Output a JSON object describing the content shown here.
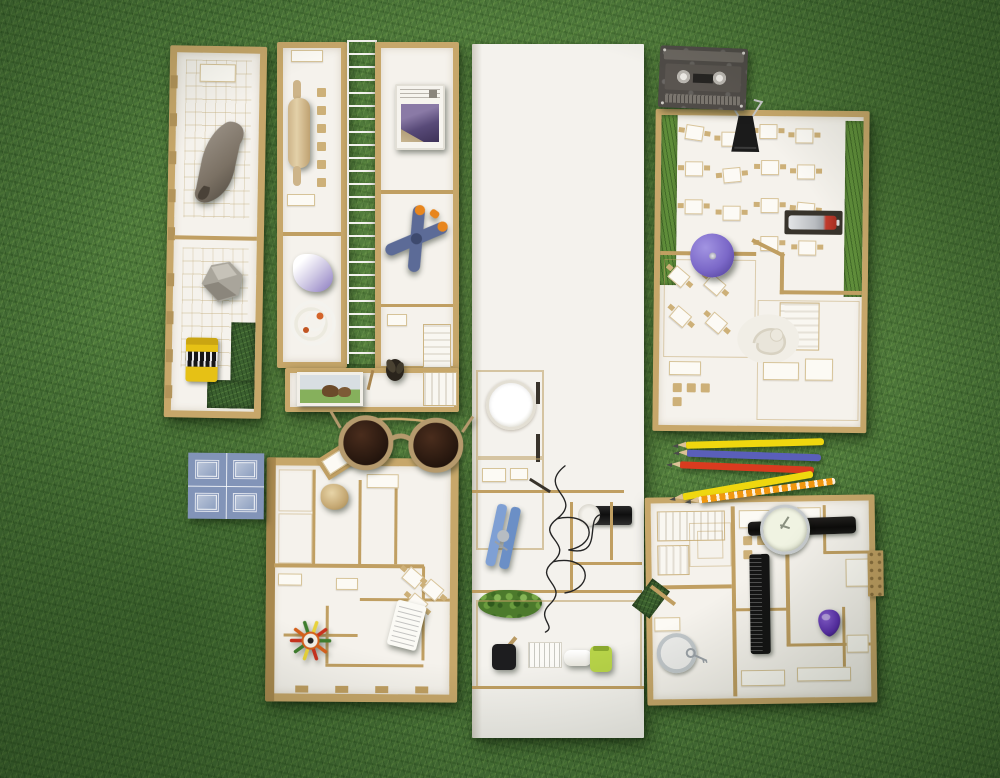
{
  "scene": {
    "title": "Architectural model flat-lay on artificial grass",
    "description": "Top-down photograph of white and cardboard architectural floor-plan models arranged on green artificial grass, staged with everyday objects used as scale props: a cassette tape, sunglasses, five colored pencils, a wristwatch, a spring clamp, a clothespin, a rolling pin, rocks, thread, a comb, a battery, a yo-yo, a blue cement tile and more."
  },
  "palette": {
    "grass_base": "#4a7539",
    "grass_dark": "#2c4f22",
    "grass_light": "#6f9c4e",
    "cardboard": "#c7a76a",
    "cardboard_dark": "#a9894f",
    "floor_white": "#f5f2ec",
    "foam_white": "#f4f2ed",
    "tile_blue": "#8294b8",
    "clamp_blue": "#5c6b97",
    "clamp_orange": "#e8861d",
    "clothespin_blue": "#7fa0d4",
    "clothespin_blue_dark": "#6b8fc6",
    "yoyo_purple": "#7a67c7",
    "pick_purple": "#5b2fae",
    "battery_red": "#c23b2c",
    "film_yellow": "#e6c115",
    "pencil_yellow": "#efd70f",
    "pencil_blue": "#5a5fb9",
    "pencil_red": "#d93b1f",
    "pencil_orange": "#f0970f",
    "bottle_green": "#b7d348",
    "moss_green": "#4c7a2c",
    "thread_black": "#242424",
    "lens_brown": "#1f120c",
    "frame_tan": "#b59a6d"
  },
  "objects": {
    "left_strip_model": {
      "label": "Narrow floor-plan model strip with desk rows and grass cut-out"
    },
    "animal_rock": {
      "label": "Animal-shaped rock lying across the plan"
    },
    "stone": {
      "label": "Grey stone"
    },
    "film_canister": {
      "label": "Yellow 35mm film canister"
    },
    "mid_left_strip_model": {
      "label": "Floor-plan strip with rolling pin meeting table"
    },
    "rolling_pin": {
      "label": "Wooden rolling pin"
    },
    "fabric_scrap": {
      "label": "White and lilac fabric scrap"
    },
    "earbuds_coil": {
      "label": "Coiled white earphones"
    },
    "horse_photo": {
      "label": "Small framed horse photograph"
    },
    "ladder_strip": {
      "label": "Translucent ladder walkway between strips"
    },
    "mid_right_strip_model": {
      "label": "Floor-plan strip with cassette case and clamp"
    },
    "cassette_case": {
      "label": "White cassette case with purple cover art"
    },
    "spring_clamp": {
      "label": "Blue spring clamp with orange grips"
    },
    "fly_figure": {
      "label": "Small dark insect figure"
    },
    "white_stairs": {
      "label": "White model staircase"
    },
    "center_tower_model": {
      "label": "Tall blank white foam slab with plan rooms at its foot"
    },
    "wall_clock": {
      "label": "Round white clock face in a room"
    },
    "clothespin": {
      "label": "Blue wooden clothespin"
    },
    "thread_spool": {
      "label": "Spool of black thread with tangled strand"
    },
    "moss_clump": {
      "label": "Clump of green moss"
    },
    "hand_mirror": {
      "label": "Small black hand mirror"
    },
    "white_crate": {
      "label": "Slatted white crate"
    },
    "white_bottle": {
      "label": "White cosmetic bottle on its side"
    },
    "green_bottle": {
      "label": "Lime green bottle"
    },
    "cassette_tape": {
      "label": "Smoky transparent audio cassette tape"
    },
    "restaurant_model": {
      "label": "Restaurant floor-plan model with grass verges and table rows"
    },
    "binder_clip": {
      "label": "Black binder clip at the model edge"
    },
    "yoyo": {
      "label": "Purple yo-yo"
    },
    "battery": {
      "label": "Silver battery with red tip in a wall slot"
    },
    "baby_sculpture": {
      "label": "White sculpted relief"
    },
    "colored_pencils": {
      "label": "Five colored pencils: yellow, blue, red, yellow, orange"
    },
    "sunglasses": {
      "label": "Round tortoiseshell sunglasses lying face down"
    },
    "blue_tile": {
      "label": "Blue geometric cement tile"
    },
    "apartment_model": {
      "label": "Apartment floor-plan model with angled bay entrance"
    },
    "head_figurine": {
      "label": "Carved head figurine"
    },
    "feather_brooch": {
      "label": "Feathered flight ornament in green, red and orange"
    },
    "receipt": {
      "label": "Curled paper receipt with fine print"
    },
    "house_model": {
      "label": "House floor-plan model with staircases and comb"
    },
    "wristwatch": {
      "label": "Wristwatch with black leather strap"
    },
    "comb": {
      "label": "Black pocket comb"
    },
    "guitar_pick": {
      "label": "Purple guitar pick"
    },
    "glass_jar": {
      "label": "Glass jar lid with a small key"
    }
  }
}
